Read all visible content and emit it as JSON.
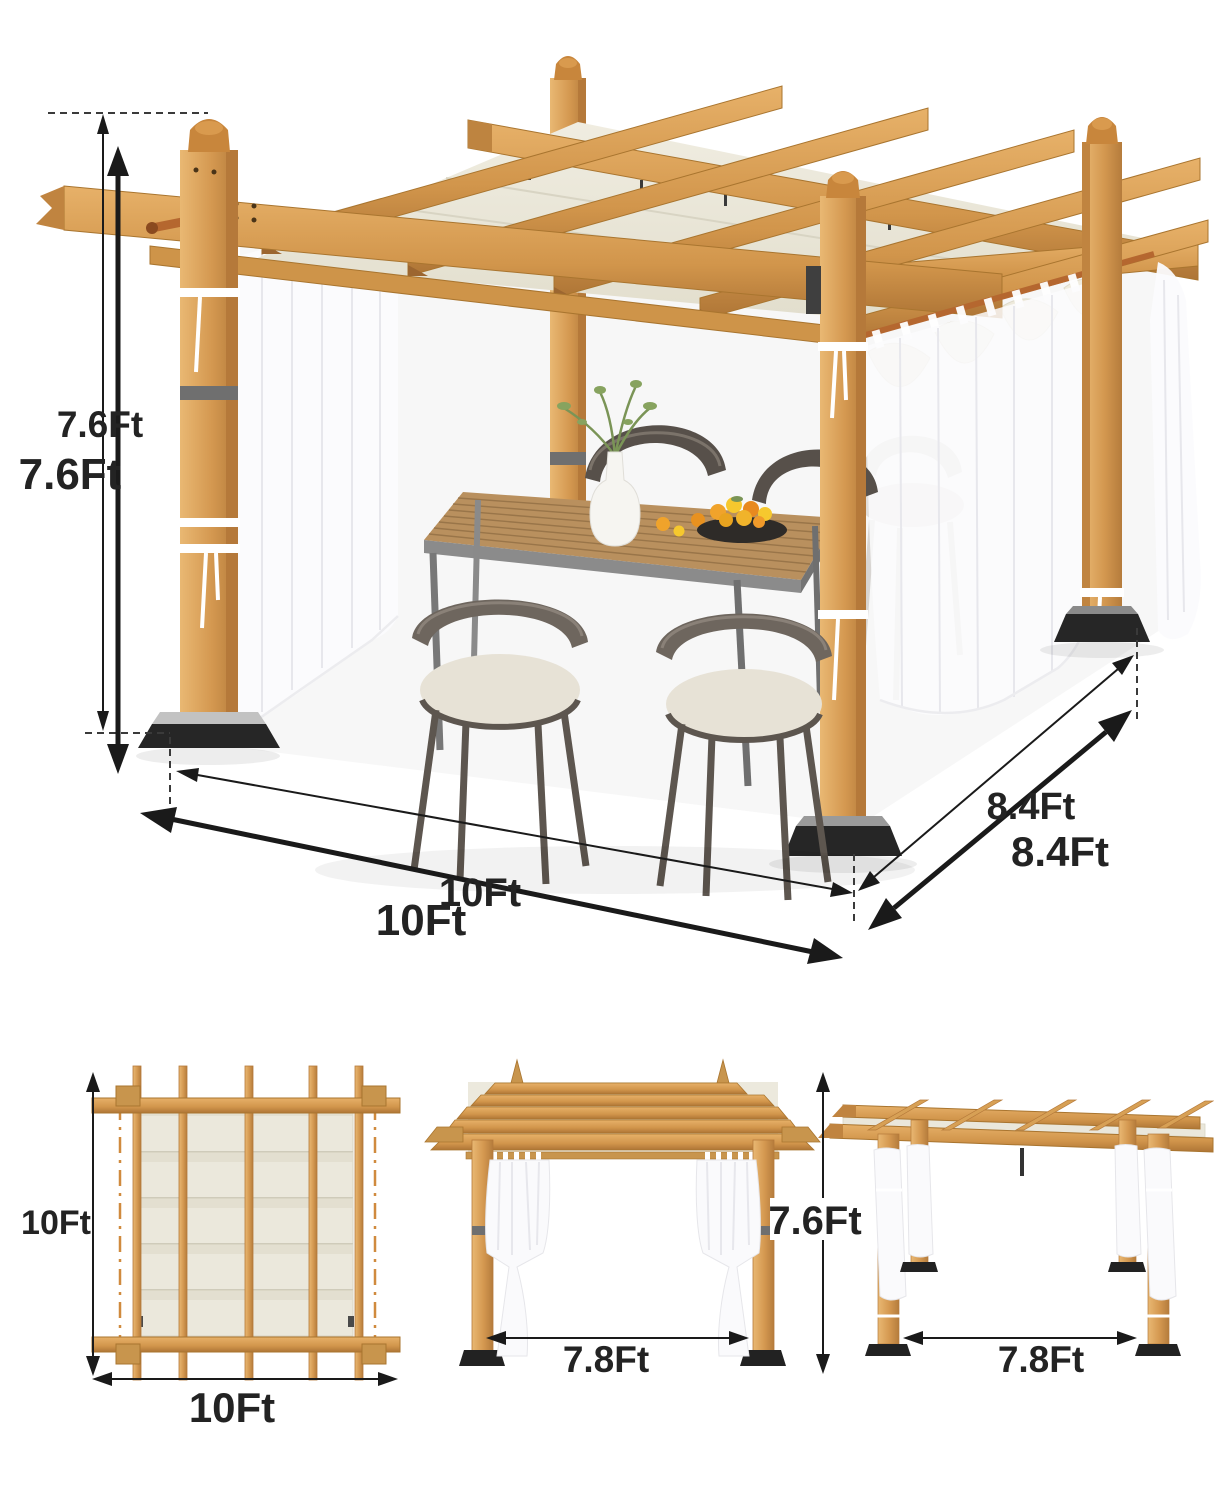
{
  "image_type": "product-dimension-diagram",
  "product": "wood-grain outdoor pergola with retractable canopy, sheer curtains and dining set",
  "units": "Ft",
  "main_view": {
    "labels": {
      "height_small": "7.6Ft",
      "height_large": "7.6Ft",
      "width_small": "10Ft",
      "width_large": "10Ft",
      "depth_small": "8.4Ft",
      "depth_large": "8.4Ft"
    }
  },
  "bottom_views": {
    "top_view": {
      "side_label": "10Ft",
      "front_label": "10Ft"
    },
    "front_view": {
      "width_label": "7.8Ft"
    },
    "side_view": {
      "height_label": "7.6Ft",
      "depth_label": "7.8Ft"
    }
  },
  "colors": {
    "wood": "#D79A4F",
    "wood_light": "#E7B36B",
    "wood_dark": "#B5793A",
    "canopy_cream": "#EBE8DB",
    "curtain_white": "#FAFAFC",
    "metal_gray": "#6F6F6F",
    "base_black": "#262626",
    "dimension_line": "#1A1A1A",
    "label_text": "#232323",
    "orange_dash": "#D08A3E",
    "table_wood": "#B9905E",
    "chair_frame": "#6E665E",
    "cushion": "#E7E2D6",
    "fruit_orange": "#F0A32B",
    "fruit_yellow": "#F6C82E",
    "leaf_green": "#7A9456"
  }
}
